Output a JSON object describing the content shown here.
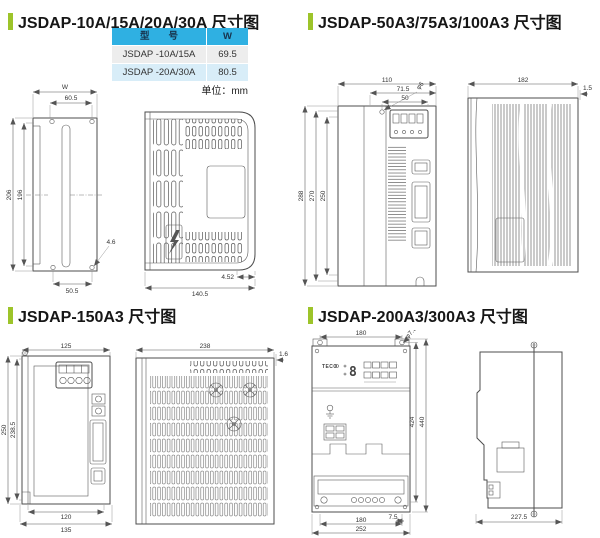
{
  "tl": {
    "title": "JSDAP-10A/15A/20A/30A 尺寸图",
    "table": {
      "h1": "型　　号",
      "h2": "W",
      "rows": [
        [
          "JSDAP -10A/15A",
          "69.5"
        ],
        [
          "JSDAP -20A/30A",
          "80.5"
        ]
      ]
    },
    "unit": "单位：mm",
    "front": {
      "w": "W",
      "w2": "60.5",
      "h": "206",
      "h2": "196",
      "b": "50.5",
      "hole": "4.6"
    },
    "side": {
      "d": "140.5",
      "d2": "4.52"
    }
  },
  "tr": {
    "title": "JSDAP-50A3/75A3/100A3 尺寸图",
    "front": {
      "w": "110",
      "w2": "71.5",
      "w3": "50",
      "hole": "φ6",
      "h": "288",
      "h2": "270",
      "h3": "250"
    },
    "side": {
      "d": "182",
      "t": "1.5"
    }
  },
  "bl": {
    "title": "JSDAP-150A3 尺寸图",
    "front": {
      "w": "125",
      "h": "250",
      "h2": "238.5",
      "b": "120",
      "b2": "135"
    },
    "side": {
      "d": "238",
      "t": "1.6"
    }
  },
  "br": {
    "title": "JSDAP-200A3/300A3 尺寸图",
    "front": {
      "w": "180",
      "hole": "φ7.5",
      "h": "424",
      "h2": "440",
      "b": "7.5",
      "b2": "180",
      "b3": "252",
      "logo": "TECO"
    },
    "side": {
      "d": "227.5"
    }
  }
}
